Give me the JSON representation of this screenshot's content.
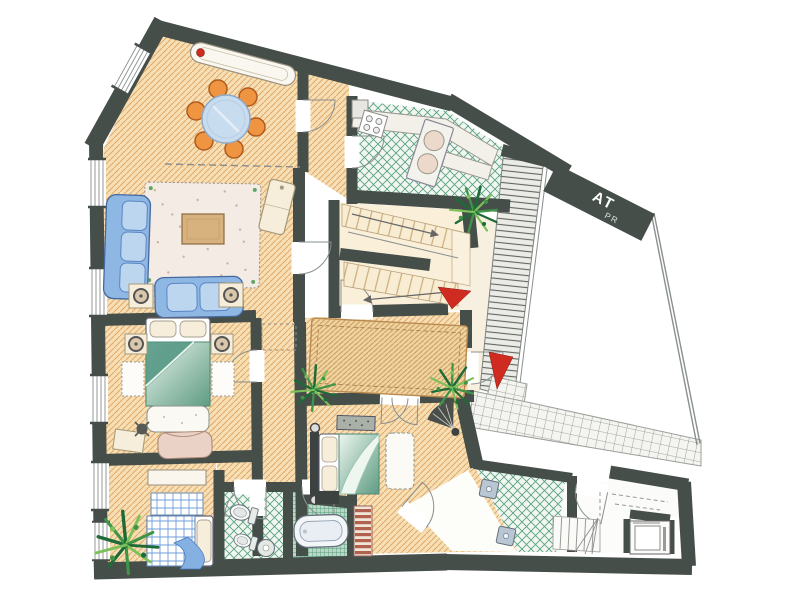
{
  "banner": {
    "line1": "AT",
    "line2": "PR"
  },
  "palette": {
    "wall": "#454e49",
    "floor_tan": "#f6dfb4",
    "floor_line": "#e2a967",
    "rug_tan": "#f0d4a2",
    "rug_line": "#c89a58",
    "stair_tan": "#f8ecd2",
    "stair_line": "#c9ad7f",
    "tile_bg": "#f1f7f0",
    "tile_line": "#5aa183",
    "grid_bg": "#b9d9c6",
    "grid_line": "#3a8a68",
    "terrace_bg": "#f4f4f0",
    "terrace_line": "#8a8f88",
    "strip_bg": "#ebebe7",
    "strip_line": "#62675f",
    "sofa_blue": "#8fb7e4",
    "sofa_blue_dark": "#44699f",
    "cushion_blue": "#bcd6f0",
    "glass_blue": "#c8dcef",
    "chair_orange": "#ef9440",
    "chair_outline": "#b05a1e",
    "teal_dark": "#5f9c85",
    "teal_mid": "#9cc3b1",
    "teal_light": "#edf5ef",
    "plaid_blue": "#6f9fd8",
    "rug_pink": "#f5ebe5",
    "rug_dot": "#cdb0a0",
    "cream": "#f6eedb",
    "cream_line": "#a59878",
    "wood": "#d8b27e",
    "wood_line": "#8a6a42",
    "accent_red": "#cf2b20",
    "radiator_red": "#a84a38",
    "plant_dark": "#1e6b38",
    "plant_mid": "#3f9448",
    "plant_light": "#7cc05a",
    "fixture": "#b9c6d4",
    "pencil": "#8a8f8f"
  }
}
